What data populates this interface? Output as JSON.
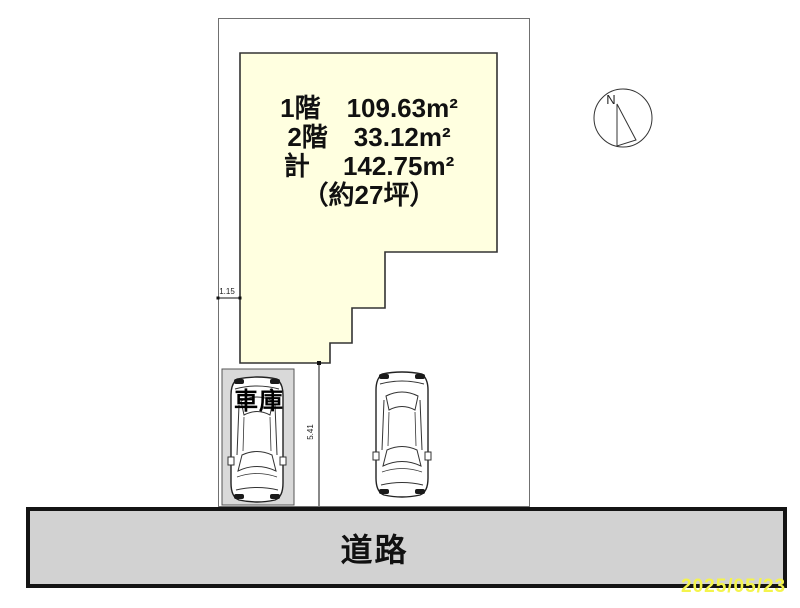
{
  "floor_area": {
    "lines": [
      "1階　109.63m²",
      "2階　33.12m²",
      "計　 142.75m²",
      "（約27坪）"
    ]
  },
  "garage": {
    "label": "車庫"
  },
  "road": {
    "label": "道路"
  },
  "compass": {
    "label": "N"
  },
  "dimensions": {
    "horizontal": "1.15",
    "vertical": "5.41"
  },
  "date_stamp": "2025/05/23",
  "colors": {
    "building_fill": "#ffffe0",
    "building_stroke": "#333333",
    "plot_stroke": "#707070",
    "garage_fill": "#d9d9d9",
    "road_fill": "#d2d2d2",
    "road_border": "#141414",
    "date_text": "#f4f44c"
  }
}
